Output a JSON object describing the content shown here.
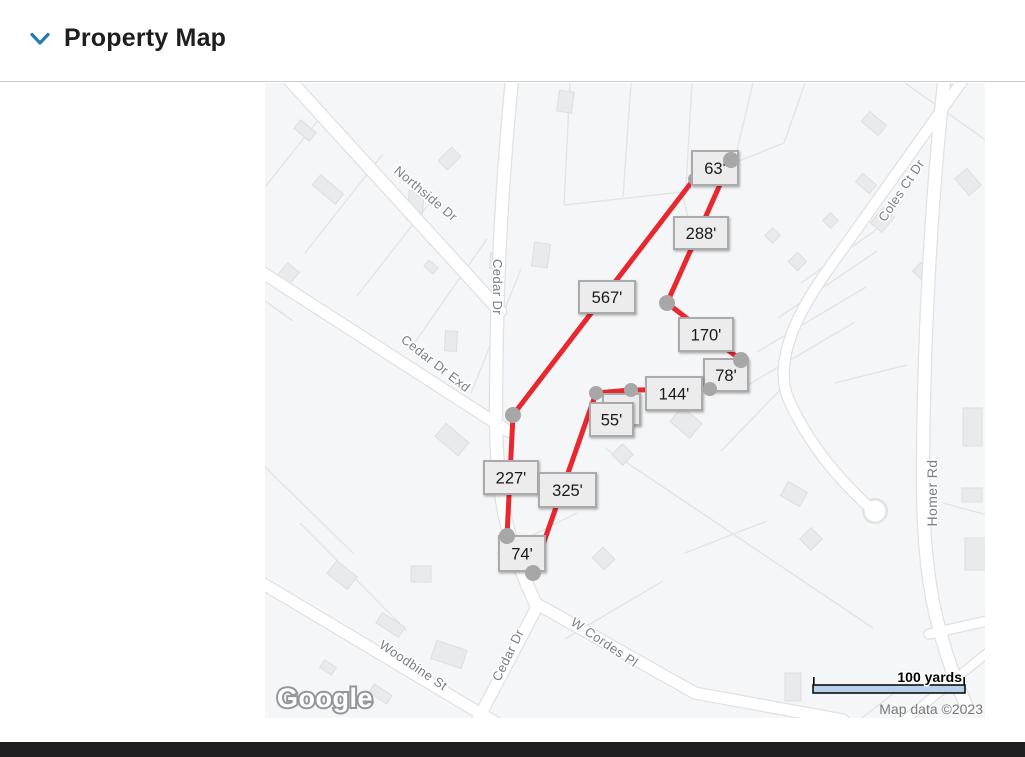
{
  "header": {
    "section_title": "Property Map",
    "accent_color": "#2879ae"
  },
  "map": {
    "logo_text": "Google",
    "attribution": "Map data ©2023",
    "scale_label": "100 yards",
    "street_labels": [
      {
        "text": "Northside Dr",
        "x": 158,
        "y": 114,
        "rot": 40,
        "size": 13
      },
      {
        "text": "Cedar Dr",
        "x": 228,
        "y": 204,
        "rot": 90,
        "size": 13
      },
      {
        "text": "Cedar Dr Exd",
        "x": 168,
        "y": 284,
        "rot": 38,
        "size": 13
      },
      {
        "text": "Coles Ct Dr",
        "x": 640,
        "y": 110,
        "rot": -56,
        "size": 13
      },
      {
        "text": "Homer Rd",
        "x": 672,
        "y": 410,
        "rot": -90,
        "size": 14
      },
      {
        "text": "Woodbine St",
        "x": 146,
        "y": 586,
        "rot": 34,
        "size": 13
      },
      {
        "text": "Cedar Dr",
        "x": 247,
        "y": 574,
        "rot": -64,
        "size": 13
      },
      {
        "text": "W Cordes Pl",
        "x": 337,
        "y": 563,
        "rot": 34,
        "size": 13
      }
    ],
    "boundary": {
      "line_color": "#e8272e",
      "vertex_color": "#a7a7a7",
      "vertices": [
        {
          "id": "A",
          "x": 466,
          "y": 77,
          "r": 8
        },
        {
          "id": "B",
          "x": 429,
          "y": 96,
          "r": 6
        },
        {
          "id": "C",
          "x": 248,
          "y": 332,
          "r": 8
        },
        {
          "id": "D",
          "x": 242,
          "y": 453,
          "r": 8
        },
        {
          "id": "E",
          "x": 268,
          "y": 490,
          "r": 8
        },
        {
          "id": "F",
          "x": 331,
          "y": 310,
          "r": 7
        },
        {
          "id": "G",
          "x": 366,
          "y": 307,
          "r": 7
        },
        {
          "id": "H",
          "x": 445,
          "y": 306,
          "r": 7
        },
        {
          "id": "I",
          "x": 476,
          "y": 277,
          "r": 8
        },
        {
          "id": "J",
          "x": 402,
          "y": 220,
          "r": 8
        }
      ],
      "segments": [
        [
          "A",
          "B"
        ],
        [
          "B",
          "C"
        ],
        [
          "C",
          "D"
        ],
        [
          "D",
          "E"
        ],
        [
          "E",
          "F"
        ],
        [
          "F",
          "G"
        ],
        [
          "G",
          "H"
        ],
        [
          "H",
          "I"
        ],
        [
          "I",
          "J"
        ],
        [
          "J",
          "A"
        ]
      ],
      "distance_labels": [
        {
          "text": "63'",
          "x": 427,
          "y": 68,
          "w": 46,
          "h": 34
        },
        {
          "text": "288'",
          "x": 409,
          "y": 134,
          "w": 54,
          "h": 32
        },
        {
          "text": "567'",
          "x": 314,
          "y": 198,
          "w": 56,
          "h": 32
        },
        {
          "text": "170'",
          "x": 414,
          "y": 235,
          "w": 54,
          "h": 33
        },
        {
          "text": "78'",
          "x": 439,
          "y": 276,
          "w": 44,
          "h": 32
        },
        {
          "text": "144'",
          "x": 381,
          "y": 294,
          "w": 56,
          "h": 33
        },
        {
          "text": "'",
          "x": 338,
          "y": 311,
          "w": 37,
          "h": 31,
          "hidden": true
        },
        {
          "text": "55'",
          "x": 325,
          "y": 320,
          "w": 43,
          "h": 33
        },
        {
          "text": "227'",
          "x": 219,
          "y": 378,
          "w": 54,
          "h": 33
        },
        {
          "text": "325'",
          "x": 274,
          "y": 390,
          "w": 57,
          "h": 34
        },
        {
          "text": "74'",
          "x": 234,
          "y": 453,
          "w": 46,
          "h": 35
        }
      ]
    }
  }
}
